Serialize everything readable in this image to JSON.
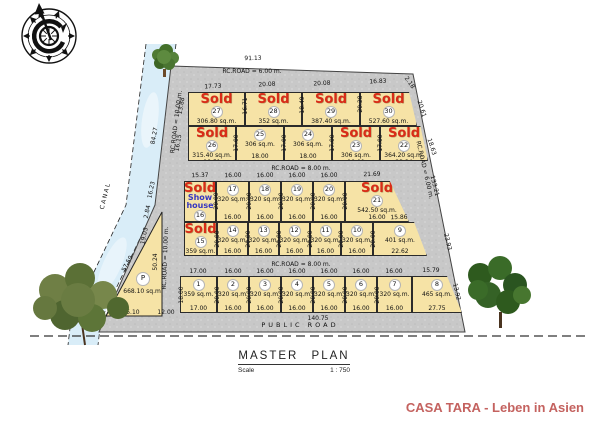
{
  "title": {
    "text": "MASTER PLAN",
    "scale_label": "Scale",
    "scale_value": "1 : 750"
  },
  "branding": {
    "text": "CASA TARA - Leben in Asien",
    "color": "#c4625f"
  },
  "labels": {
    "sold": "Sold",
    "show_house": "Show\nhouse",
    "canal": "CANAL",
    "public_road": "PUBLIC  ROAD",
    "road_top": "RC.ROAD  =  6.00 m.",
    "road_mid_upper": "RC.ROAD  =  8.00 m.",
    "road_mid_lower": "RC.ROAD  =  8.00 m.",
    "road_left_upper": "RC.ROAD  =  10.00 m.",
    "road_left_lower": "RC.ROAD  =  10.00 m.",
    "road_right": "RC.ROAD  =  6.00 m."
  },
  "parking": {
    "letter": "P",
    "area": "668.10  sq.m."
  },
  "colors": {
    "lot_fill": "#f6e3a6",
    "sold_red": "#d92c18",
    "show_blue": "#3636c0",
    "road_gray": "#c8c8c8",
    "canal_blue": "#d9edf8"
  },
  "lots": {
    "rows": [
      [
        {
          "number": "27",
          "sold": true,
          "area": "306.80 sq.m.",
          "dim_bottom": "18.00",
          "dim_right": "2.00"
        },
        {
          "number": "28",
          "sold": true,
          "area": "352 sq.m.",
          "dim_bottom": "16.00",
          "dim_right": "4.00"
        },
        {
          "number": "29",
          "sold": true,
          "area": "387.40 sq.m.",
          "dim_bottom": "14.00",
          "dim_right": "6.00"
        },
        {
          "number": "30",
          "sold": true,
          "area": "527.60 sq.m.",
          "dim_bottom": "12.00",
          "dim_right": "17.72"
        }
      ],
      [
        {
          "number": "26",
          "sold": true,
          "area": "315.40 sq.m.",
          "dim_bottom": "18.51"
        },
        {
          "number": "25",
          "sold": false,
          "area": "306 sq.m.",
          "dim_bottom": "18.00"
        },
        {
          "number": "24",
          "sold": false,
          "area": "306 sq.m.",
          "dim_bottom": "18.00"
        },
        {
          "number": "23",
          "sold": true,
          "area": "306 sq.m.",
          "dim_bottom": "18.00"
        },
        {
          "number": "22",
          "sold": true,
          "area": "364.20 sq.m.",
          "dim_bottom": "23.34"
        }
      ],
      [
        {
          "number": "16",
          "sold": true,
          "show_house": true,
          "dim_bottom": "18.00"
        },
        {
          "number": "17",
          "sold": false,
          "area": "320 sq.m.",
          "dim_bottom": "16.00"
        },
        {
          "number": "18",
          "sold": false,
          "area": "320 sq.m.",
          "dim_bottom": "16.00"
        },
        {
          "number": "19",
          "sold": false,
          "area": "320 sq.m.",
          "dim_bottom": "16.00"
        },
        {
          "number": "20",
          "sold": false,
          "area": "320 sq.m.",
          "dim_bottom": "16.00"
        },
        {
          "number": "21",
          "sold": true,
          "area": "542.50 sq.m.",
          "dim_bottom": "16.00"
        }
      ],
      [
        {
          "number": "15",
          "sold": true,
          "area": "359 sq.m.",
          "dim_bottom": "17.00"
        },
        {
          "number": "14",
          "sold": false,
          "area": "320 sq.m.",
          "dim_bottom": "16.00"
        },
        {
          "number": "13",
          "sold": false,
          "area": "320 sq.m.",
          "dim_bottom": "16.00"
        },
        {
          "number": "12",
          "sold": false,
          "area": "320 sq.m.",
          "dim_bottom": "16.00"
        },
        {
          "number": "11",
          "sold": false,
          "area": "320 sq.m.",
          "dim_bottom": "16.00"
        },
        {
          "number": "10",
          "sold": false,
          "area": "320 sq.m.",
          "dim_bottom": "16.00"
        },
        {
          "number": "9",
          "sold": false,
          "area": "401 sq.m.",
          "dim_bottom": "22.62"
        }
      ],
      [
        {
          "number": "1",
          "sold": false,
          "area": "359 sq.m.",
          "dim_bottom": "17.00"
        },
        {
          "number": "2",
          "sold": false,
          "area": "320 sq.m.",
          "dim_bottom": "16.00"
        },
        {
          "number": "3",
          "sold": false,
          "area": "320 sq.m.",
          "dim_bottom": "16.00"
        },
        {
          "number": "4",
          "sold": false,
          "area": "320 sq.m.",
          "dim_bottom": "16.00"
        },
        {
          "number": "5",
          "sold": false,
          "area": "320 sq.m.",
          "dim_bottom": "16.00"
        },
        {
          "number": "6",
          "sold": false,
          "area": "320 sq.m.",
          "dim_bottom": "16.00"
        },
        {
          "number": "7",
          "sold": false,
          "area": "320 sq.m.",
          "dim_bottom": "16.00"
        },
        {
          "number": "8",
          "sold": false,
          "area": "465 sq.m.",
          "dim_bottom": "27.75"
        }
      ]
    ]
  },
  "dims": {
    "d_total_top": "91.13",
    "d_t27": "17.73",
    "d_t28": "20.08",
    "d_t29": "20.08",
    "d_t30": "16.83",
    "d_c218": "2.18",
    "d_s2728": "16.71",
    "d_s2829": "18.49",
    "d_s2930": "20.28",
    "d_l1388": "13.88",
    "d_l1615": "16.15",
    "d_s26": "17.00",
    "d_s25": "17.00",
    "d_s24": "17.00",
    "d_s23": "17.00",
    "d_r2061": "20.61",
    "d_r1863": "18.63",
    "d_t16": "15.37",
    "d_t17": "16.00",
    "d_t18": "16.00",
    "d_t19": "16.00",
    "d_t20": "16.00",
    "d_t21": "21.69",
    "d_s16": "20.00",
    "d_s17": "20.00",
    "d_s18": "20.00",
    "d_s19": "20.00",
    "d_s20": "20.00",
    "d_1586": "15.86",
    "d_s15": "20.00",
    "d_s14": "20.00",
    "d_s13": "20.00",
    "d_s12": "20.00",
    "d_s11": "20.00",
    "d_s10": "20.00",
    "d_l1623": "16.23",
    "d_l284": "2.84",
    "d_l1903": "19.03",
    "d_2510": "25.10",
    "d_1200": "12.00",
    "d_5750": "57.50",
    "d_5024": "50.24",
    "d_8427": "84.27",
    "d_13321": "133.21",
    "d_2393": "23.93",
    "d_1392": "13.92",
    "d_bt1": "17.00",
    "d_bt2": "16.00",
    "d_bt3": "16.00",
    "d_bt4": "16.00",
    "d_bt5": "16.00",
    "d_bt6": "16.00",
    "d_bt7": "16.00",
    "d_bt8": "15.79",
    "d_sb1": "18.00",
    "d_sb2": "20.00",
    "d_sb3": "20.00",
    "d_sb4": "20.00",
    "d_sb5": "20.00",
    "d_sb6": "20.00",
    "d_sb7": "20.00",
    "d_total_bottom": "140.75"
  }
}
